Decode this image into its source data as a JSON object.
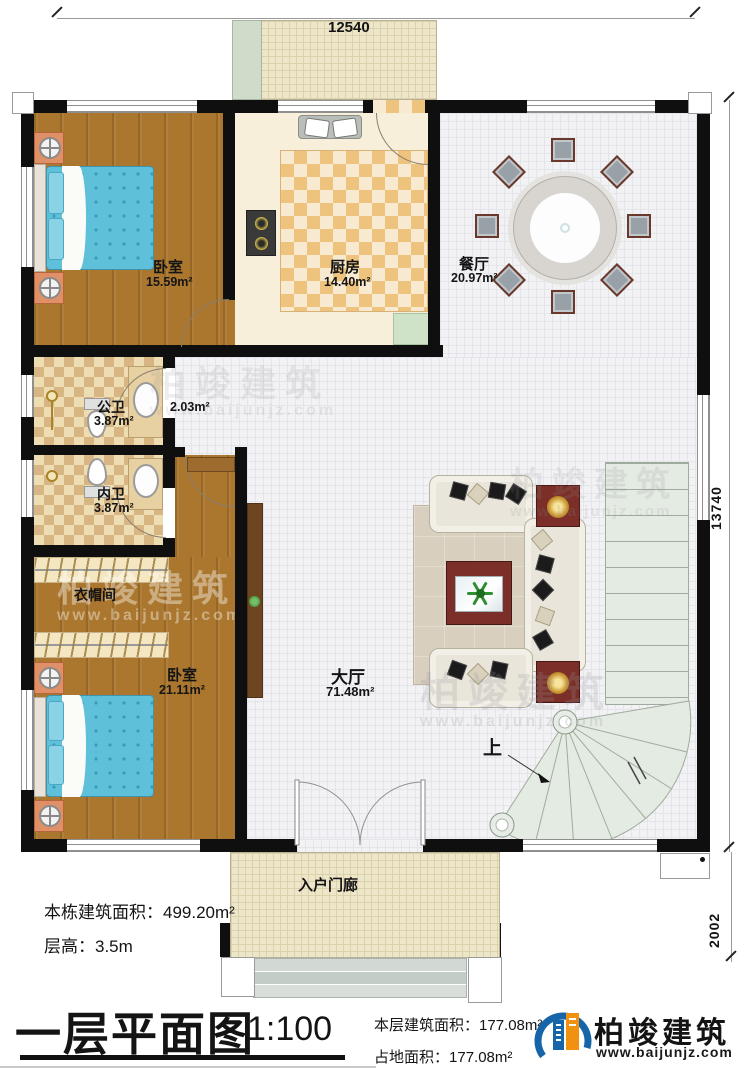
{
  "dimensions": {
    "top": "12540",
    "right": "13740",
    "bottom_right": "2002"
  },
  "rooms": [
    {
      "name": "卧室",
      "area": "15.59m²"
    },
    {
      "name": "厨房",
      "area": "14.40m²"
    },
    {
      "name": "餐厅",
      "area": "20.97m²"
    },
    {
      "name": "公卫",
      "area": "3.87m²"
    },
    {
      "name": "",
      "area": "2.03m²"
    },
    {
      "name": "内卫",
      "area": "3.87m²"
    },
    {
      "name": "衣帽间",
      "area": ""
    },
    {
      "name": "卧室",
      "area": "21.11m²"
    },
    {
      "name": "大厅",
      "area": "71.48m²"
    },
    {
      "name": "入户门廊",
      "area": ""
    }
  ],
  "stairs": {
    "up_label": "上"
  },
  "notes": {
    "building_area_label": "本栋建筑面积：",
    "building_area_value": "499.20m²",
    "floor_height_label": "层高：",
    "floor_height_value": "3.5m"
  },
  "titleblock": {
    "title": "一层平面图",
    "scale": "1:100",
    "floor_area_label": "本层建筑面积：",
    "floor_area_value": "177.08m²",
    "footprint_label": "占地面积：",
    "footprint_value": "177.08m²"
  },
  "brand": {
    "name": "柏竣建筑",
    "website": "www.baijunjz.com"
  },
  "watermark": {
    "name": "柏竣建筑",
    "website": "www.baijunjz.com"
  },
  "colors": {
    "wall": "#0f0f0f",
    "wood_floor": "#ab772f",
    "kitchen_tile": "#eec37e",
    "bath_tile": "#d8b684",
    "stair": "#e4ebe2",
    "brand_blue": "#1565a8",
    "brand_orange": "#f0920f"
  }
}
